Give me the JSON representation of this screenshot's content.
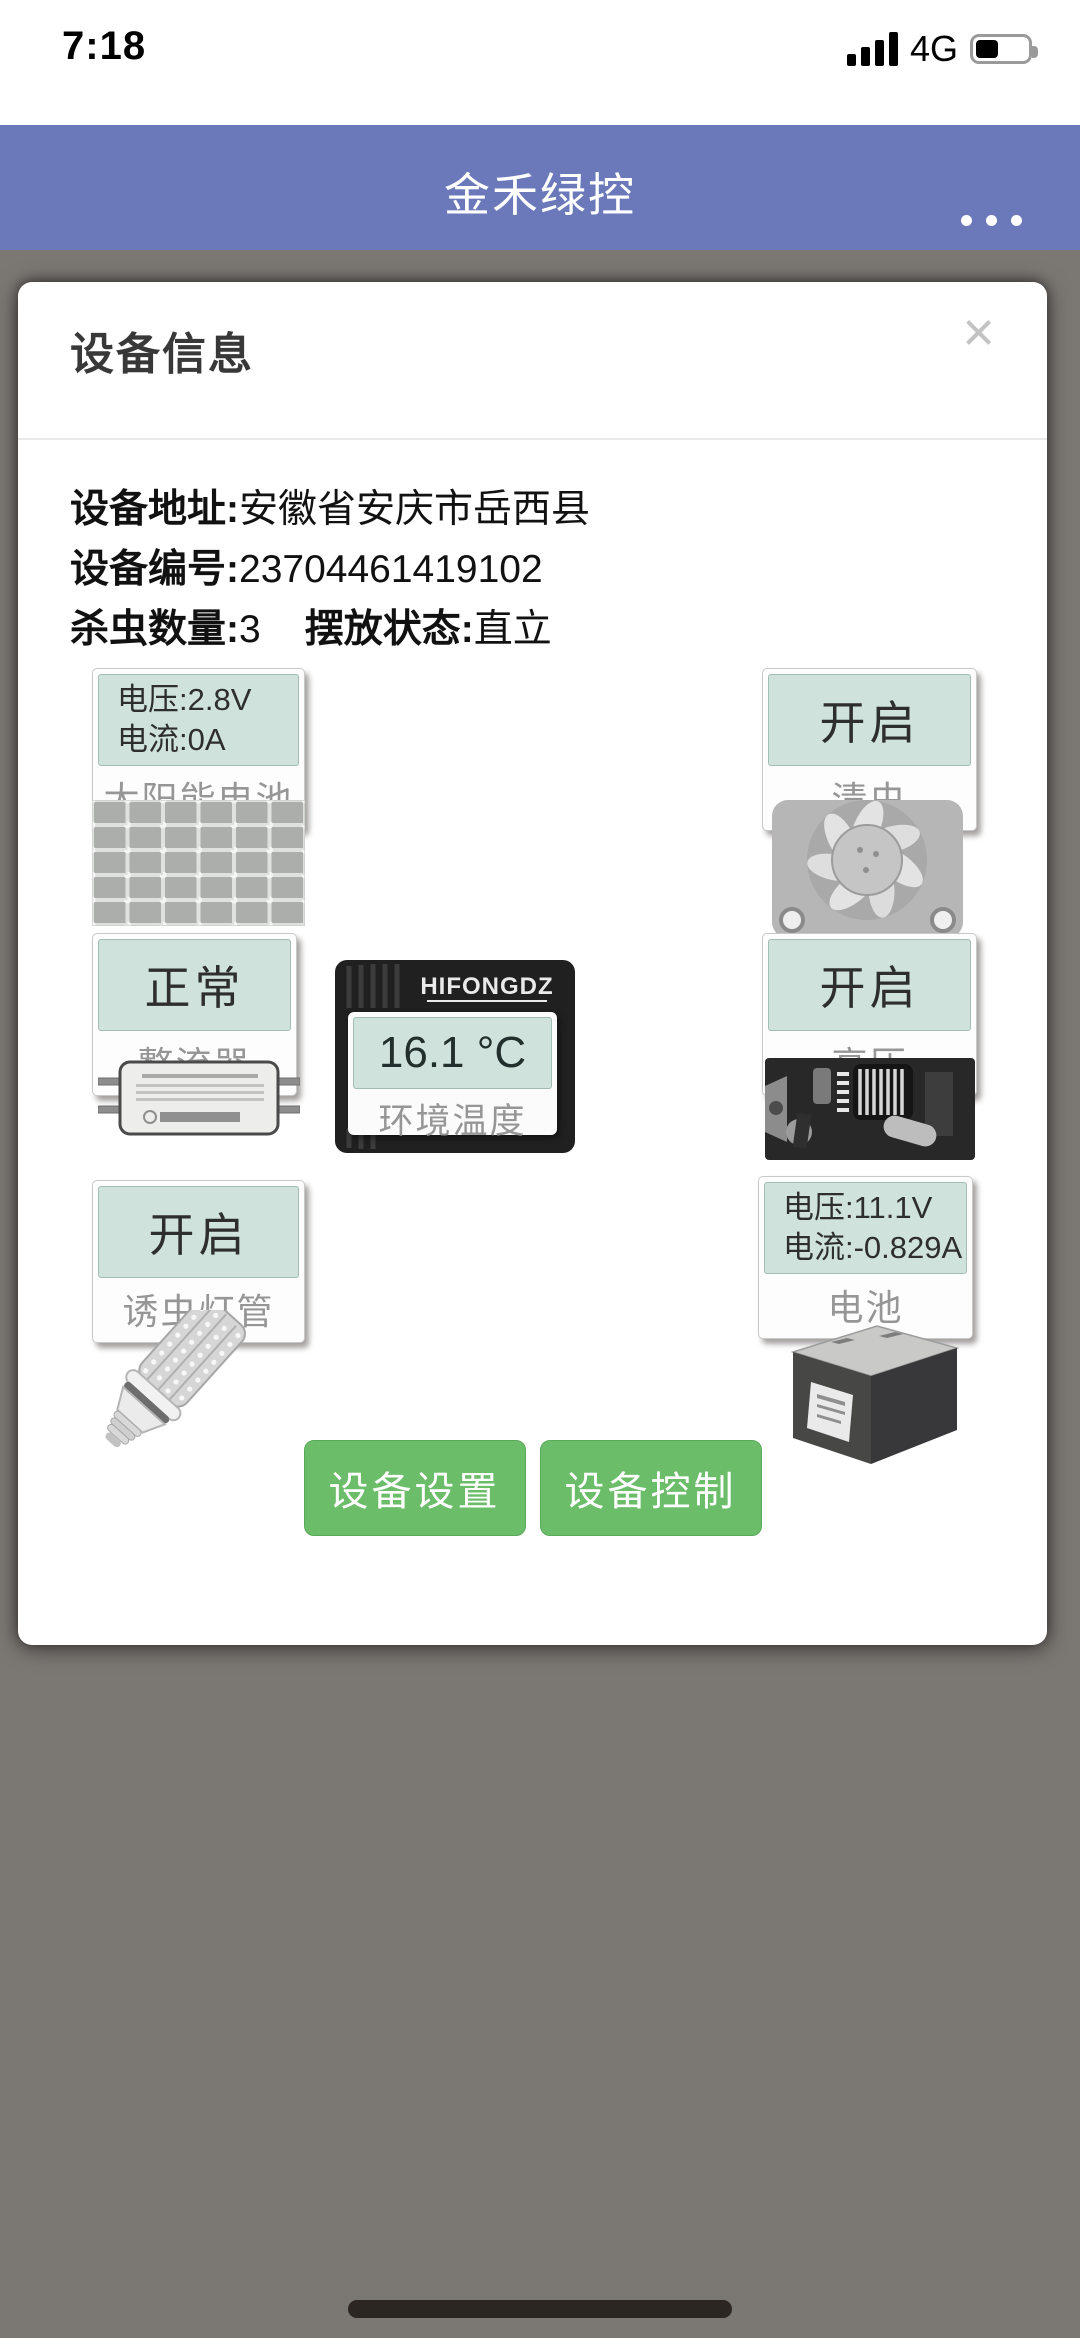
{
  "status_bar": {
    "time": "7:18",
    "network": "4G",
    "battery_level_percent": 35,
    "signal_bars": 4
  },
  "header": {
    "title": "金禾绿控",
    "menu_icon": "more-dots"
  },
  "modal": {
    "title": "设备信息",
    "close_icon": "×",
    "info": {
      "address_label": "设备地址:",
      "address_value": "安徽省安庆市岳西县",
      "serial_label": "设备编号:",
      "serial_value": "23704461419102",
      "kill_label": "杀虫数量:",
      "kill_value": "3",
      "posture_label": "摆放状态:",
      "posture_value": "直立"
    },
    "components": {
      "solar": {
        "line1": "电压:2.8V",
        "line2": "电流:0A",
        "label": "太阳能电池"
      },
      "fan": {
        "status": "开启",
        "label": "清虫"
      },
      "rectifier": {
        "status": "正常",
        "label": "整流器"
      },
      "temperature": {
        "value": "16.1 °C",
        "label": "环境温度",
        "device_brand": "HIFONGDZ",
        "device_sub": "Programmable"
      },
      "high_voltage": {
        "status": "开启",
        "label": "高压"
      },
      "lamp": {
        "status": "开启",
        "label": "诱虫灯管"
      },
      "battery": {
        "line1": "电压:11.1V",
        "line2": "电流:-0.829A",
        "label": "电池"
      }
    },
    "buttons": {
      "settings": "设备设置",
      "control": "设备控制"
    }
  },
  "colors": {
    "header_blue": "#6b79ba",
    "overlay_gray": "#7b7773",
    "display_teal": "#cfe3dc",
    "button_green": "#6bbd6a",
    "label_gray": "#969696"
  }
}
